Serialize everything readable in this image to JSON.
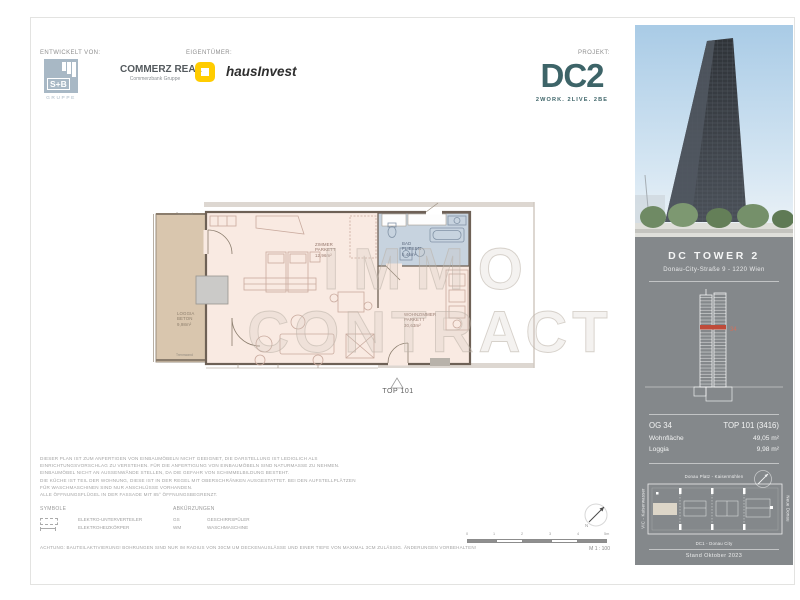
{
  "header": {
    "developed_by_label": "ENTWICKELT VON:",
    "owner_label": "EIGENTÜMER:",
    "project_label": "PROJEKT:",
    "sb_logo": {
      "name": "S+B",
      "sub": "GRUPPE"
    },
    "commerz_real": {
      "title": "COMMERZ REAL",
      "subtitle": "Commerzbank Gruppe"
    },
    "hausinvest_label": "hausInvest",
    "dc2": {
      "title": "DC2",
      "tagline": "2WORK. 2LIVE. 2BE"
    }
  },
  "floorplan": {
    "unit_marker_label": "TOP 101",
    "partition_label_top": "Trennwand",
    "partition_label_bottom": "Trennwand",
    "rooms": [
      {
        "name": "LOGGIA",
        "surface": "BETON",
        "area": "9,98m²"
      },
      {
        "name": "ZIMMER",
        "surface": "PARKETT",
        "area": "12,96m²"
      },
      {
        "name": "BAD",
        "surface": "FLIESEN",
        "area": "5,46m²"
      },
      {
        "name": "WOHNZIMMER",
        "surface": "PARKETT",
        "area": "30,63m²"
      }
    ],
    "watermark_line1": "IMMO",
    "watermark_line2": "CONTRACT"
  },
  "sidebar": {
    "building_name": "DC TOWER 2",
    "address": "Donau-City-Straße 9 - 1220 Wien",
    "cross_section_floor": "34",
    "info": {
      "floor_label": "OG 34",
      "unit_label": "TOP 101 (3416)",
      "living_area_label": "Wohnfläche",
      "living_area_value": "49,05 m²",
      "loggia_label": "Loggia",
      "loggia_value": "9,98 m²"
    },
    "siteplan": {
      "label_north": "Donau Platz - Kaisermühlen",
      "label_west": "VIC - Kaiserwasser",
      "label_east": "Neue Donau",
      "label_south": "DC1 - Donau City"
    },
    "date_note": "Stand Oktober 2023"
  },
  "legal": {
    "lines": [
      "DIESER PLAN IST ZUM ANFERTIGEN VON EINBAUMÖBELN NICHT GEEIGNET, DIE DARSTELLUNG IST LEDIGLICH ALS",
      "EINRICHTUNGSVORSCHLAG ZU VERSTEHEN. FÜR DIE ANFERTIGUNG VON EINBAUMÖBELN SIND NATURMASSE ZU NEHMEN.",
      "EINBAUMÖBEL NICHT AN AUSSENWÄNDE STELLEN, DA DIE GEFAHR VON SCHIMMELBILDUNG BESTEHT.",
      "DIE KÜCHE IST TEIL DER WOHNUNG, DIESE IST IN DER REGEL MIT OBERSCHRÄNKEN AUSGESTATTET. BEI DEN AUFSTELLPLÄTZEN",
      "FÜR WASCHMASCHINEN SIND NUR ANSCHLÜSSE VORHANDEN.",
      "ALLE ÖFFNUNGSFLÜGEL IN DER FASSADE MIT 85° ÖFFNUNGSBEGRENZT."
    ],
    "symbols_header": "SYMBOLE",
    "symbols": [
      {
        "label": "ELEKTRO-UNTERVERTEILER"
      },
      {
        "label": "ELEKTROHEIZKÖRPER"
      }
    ],
    "abbreviations_header": "ABKÜRZUNGEN",
    "abbreviations": [
      {
        "abbr": "GS",
        "label": "GESCHIRRSPÜLER"
      },
      {
        "abbr": "WM",
        "label": "WASCHMASCHINE"
      }
    ],
    "caution": "ACHTUNG: BAUTEILAKTIVIERUNG! BOHRUNGEN SIND NUR IM RADIUS VON 30CM UM DECKENAUSLÄSSE UND EINER TIEFE VON MAXIMAL 3CM ZULÄSSIG. ÄNDERUNGEN VORBEHALTEN!"
  },
  "scalebar": {
    "ticks": [
      "0",
      "1",
      "2",
      "3",
      "4",
      "5m"
    ],
    "scale_label": "M 1 : 100",
    "north_label": "N"
  },
  "colors": {
    "dc2_teal": "#3d6468",
    "commerzbank_yellow": "#ffcc00",
    "panel_gray": "#84888b",
    "loggia_fill": "#d9c6ae",
    "interior_fill": "#f9eae2",
    "bath_fill": "#c7d3df",
    "floor_highlight_red": "#bf4b3a"
  }
}
